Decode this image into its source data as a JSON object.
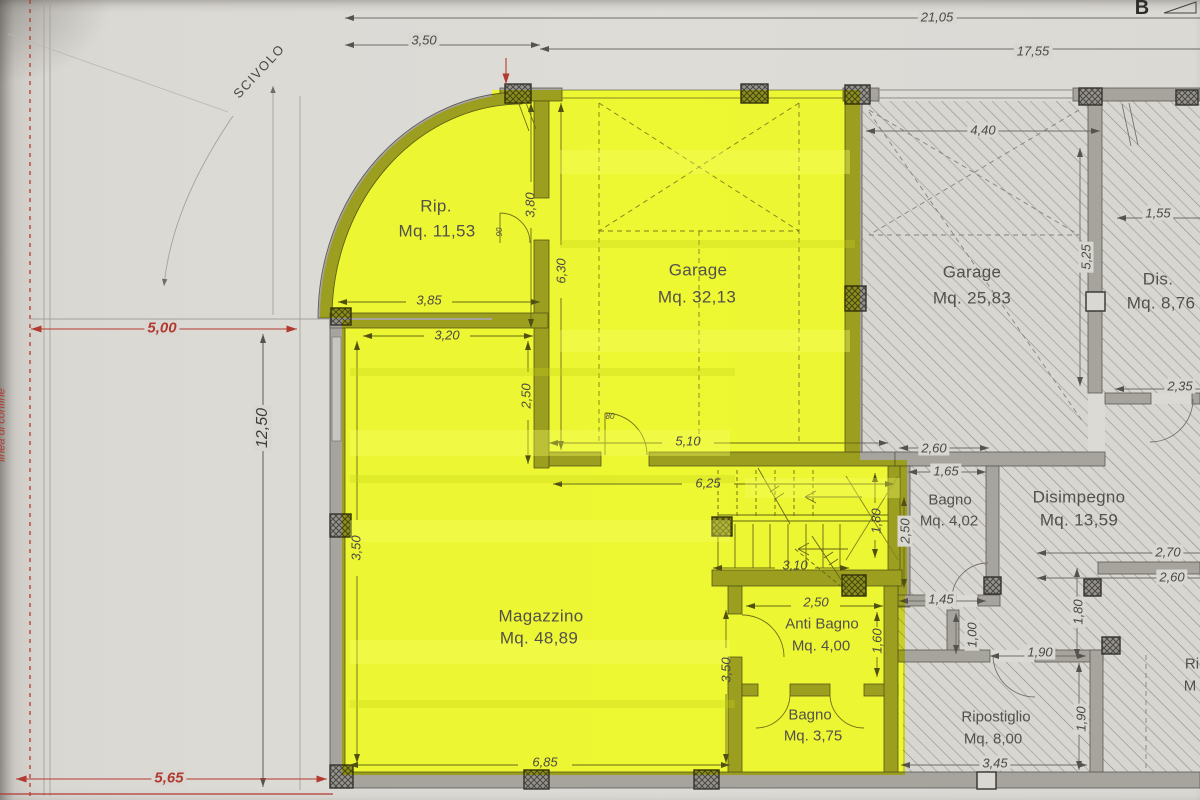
{
  "meta": {
    "section_marker": "B",
    "ramp_label": "SCIVOLO",
    "boundary_label": "linea di confine",
    "partial_line1": "Ri",
    "partial_line2": "M"
  },
  "rooms": {
    "rip": {
      "name": "Rip.",
      "area": "Mq. 11,53"
    },
    "garage1": {
      "name": "Garage",
      "area": "Mq. 32,13"
    },
    "garage2": {
      "name": "Garage",
      "area": "Mq. 25,83"
    },
    "dis": {
      "name": "Dis.",
      "area": "Mq. 8,76"
    },
    "bagno1": {
      "name": "Bagno",
      "area": "Mq. 4,02"
    },
    "disimpegno": {
      "name": "Disimpegno",
      "area": "Mq. 13,59"
    },
    "magazzino": {
      "name": "Magazzino",
      "area": "Mq. 48,89"
    },
    "antibagno": {
      "name": "Anti Bagno",
      "area": "Mq. 4,00"
    },
    "bagno2": {
      "name": "Bagno",
      "area": "Mq. 3,75"
    },
    "ripostiglio": {
      "name": "Ripostiglio",
      "area": "Mq. 8,00"
    }
  },
  "dims": {
    "total_width": "21,05",
    "inner_width": "17,55",
    "left_offset": "3,50",
    "setback_red": "5,00",
    "side_total": "12,50",
    "bottom_red": "5,65",
    "garage2_door": "4,40",
    "dis_width": "1,55",
    "garage2_depth": "5,25",
    "rip_depth": "3,80",
    "garage1_depth": "6,30",
    "rip_width": "3,85",
    "mag_top": "3,20",
    "mag_step": "2,50",
    "garage1_width": "5,10",
    "bagno1_outer": "2,60",
    "bagno1_width": "1,65",
    "corridor": "6,25",
    "bagno1_depth": "2,50",
    "bagno1_bottom": "1,45",
    "dis2_w1": "2,70",
    "dis2_w2": "2,60",
    "stairs_depth": "1,80",
    "stairs_width": "3,10",
    "antibagno_width": "2,50",
    "antibagno_depth": "1,60",
    "mag_right": "3,50",
    "niche_width": "1,00",
    "ripo_door": "1,90",
    "niche_depth": "1,80",
    "ripo_depth": "1,90",
    "mag_bottom": "6,85",
    "ripo_bottom": "3,45",
    "dis_bottom": "2,35",
    "door_w_80": "80",
    "door_w_90": "90"
  },
  "colors": {
    "highlight": "#d8e81f",
    "red": "#b23a31",
    "paper": "#dad8d3",
    "wall": "#a7a39d",
    "hatch_line": "#9b988f",
    "ink": "#4b4944"
  }
}
